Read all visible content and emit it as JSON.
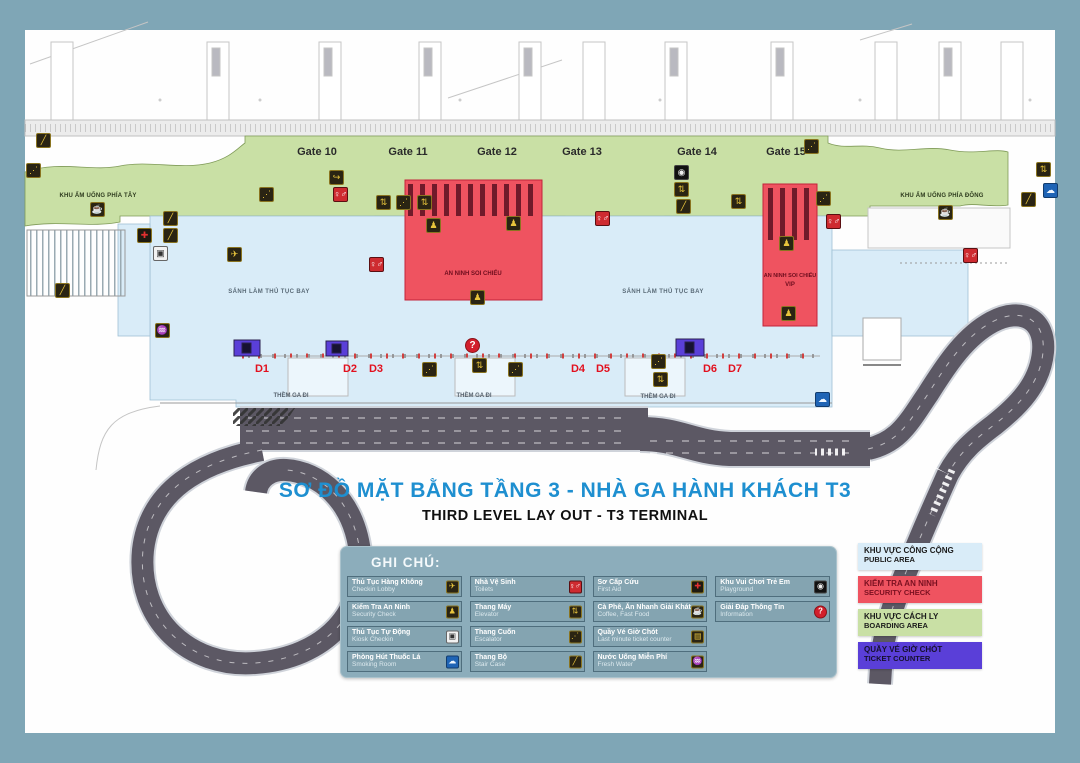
{
  "title": {
    "vi": "SƠ ĐỒ MẶT BẰNG TẦNG 3 - NHÀ GA HÀNH KHÁCH T3",
    "en": "THIRD LEVEL LAY OUT - T3 TERMINAL"
  },
  "gates": [
    "Gate 10",
    "Gate 11",
    "Gate  12",
    "Gate  13",
    "Gate 14",
    "Gate  15"
  ],
  "zones": {
    "west_food": "KHU ẨM UỐNG PHÍA TÂY",
    "east_food": "KHU ẨM UỐNG PHÍA ĐÔNG",
    "hall": "SẢNH LÀM THỦ TỤC BAY",
    "security_center": "AN NINH SOI CHIẾU",
    "security_vip_line1": "AN NINH SOI CHIẾU",
    "security_vip_line2": "VIP",
    "curb": "THỀM GA ĐI"
  },
  "d_labels": [
    "D1",
    "D2",
    "D3",
    "D4",
    "D5",
    "D6",
    "D7"
  ],
  "legend": {
    "title": "GHI CHÚ:",
    "items": [
      {
        "vi": "Thủ Tục Hàng Không",
        "en": "Checkin Lobby",
        "icon": "checkin",
        "row": 1,
        "col": 1
      },
      {
        "vi": "Nhà Vệ Sinh",
        "en": "Toilets",
        "icon": "toilets",
        "row": 1,
        "col": 2
      },
      {
        "vi": "Sơ Cấp Cứu",
        "en": "First Aid",
        "icon": "firstaid",
        "row": 1,
        "col": 3
      },
      {
        "vi": "Khu Vui Chơi Trẻ Em",
        "en": "Playground",
        "icon": "playground",
        "row": 1,
        "col": 4
      },
      {
        "vi": "Kiểm Tra An Ninh",
        "en": "Security Check",
        "icon": "security",
        "row": 2,
        "col": 1
      },
      {
        "vi": "Thang Máy",
        "en": "Elevator",
        "icon": "elevator",
        "row": 2,
        "col": 2
      },
      {
        "vi": "Cà Phê, Ăn Nhanh Giải Khát",
        "en": "Coffee, Fast Food",
        "icon": "coffee",
        "row": 2,
        "col": 3
      },
      {
        "vi": "Giải Đáp Thông Tin",
        "en": "Information",
        "icon": "info",
        "row": 2,
        "col": 4
      },
      {
        "vi": "Thủ Tục Tự Động",
        "en": "Kiosk Checkin",
        "icon": "kiosk",
        "row": 3,
        "col": 1
      },
      {
        "vi": "Thang Cuốn",
        "en": "Escalator",
        "icon": "escalator",
        "row": 3,
        "col": 2
      },
      {
        "vi": "Quầy Vé Giờ Chót",
        "en": "Last minute ticket counter",
        "icon": "ticket",
        "row": 3,
        "col": 3
      },
      {
        "vi": "Phòng Hút Thuốc Lá",
        "en": "Smoking Room",
        "icon": "smoking",
        "row": 4,
        "col": 1
      },
      {
        "vi": "Thang Bộ",
        "en": "Stair Case",
        "icon": "stairs",
        "row": 4,
        "col": 2
      },
      {
        "vi": "Nước Uống Miễn Phí",
        "en": "Fresh Water",
        "icon": "water",
        "row": 4,
        "col": 3
      }
    ]
  },
  "area_legend": [
    {
      "vi": "KHU VỰC CÔNG CỘNG",
      "en": "PUBLIC AREA",
      "color": "#D9ECF8",
      "text": "#1c1c1c"
    },
    {
      "vi": "KIỂM TRA AN NINH",
      "en": "SECURITY CHECK",
      "color": "#EF5360",
      "text": "#7A1020"
    },
    {
      "vi": "KHU VỰC CÁCH LY",
      "en": "BOARDING AREA",
      "color": "#C9E0A5",
      "text": "#1c1c1c"
    },
    {
      "vi": "QUẦY VÉ GIỜ CHÓT",
      "en": "TICKET COUNTER",
      "color": "#5A3FD8",
      "text": "#16102e"
    }
  ],
  "icon_defs": {
    "checkin": {
      "glyph": "✈",
      "bg": "#2A2413",
      "fg": "#E9C53C",
      "bd": "#8A7420"
    },
    "security": {
      "glyph": "♟",
      "bg": "#2A2413",
      "fg": "#E9C53C",
      "bd": "#8A7420"
    },
    "elevator": {
      "glyph": "⇅",
      "bg": "#2A2413",
      "fg": "#E9C53C",
      "bd": "#8A7420"
    },
    "escalator": {
      "glyph": "⋰",
      "bg": "#2A2413",
      "fg": "#E9C53C",
      "bd": "#8A7420"
    },
    "stairs": {
      "glyph": "╱",
      "bg": "#2A2413",
      "fg": "#E9C53C",
      "bd": "#8A7420"
    },
    "coffee": {
      "glyph": "☕",
      "bg": "#2A2413",
      "fg": "#E9C53C",
      "bd": "#8A7420"
    },
    "water": {
      "glyph": "♒",
      "bg": "#2A2413",
      "fg": "#E9C53C",
      "bd": "#8A7420"
    },
    "ticket": {
      "glyph": "▤",
      "bg": "#2A2413",
      "fg": "#E9C53C",
      "bd": "#8A7420"
    },
    "arrow": {
      "glyph": "↪",
      "bg": "#2A2413",
      "fg": "#E9C53C",
      "bd": "#8A7420"
    },
    "toilets": {
      "glyph": "♀♂",
      "bg": "#CE2B30",
      "fg": "#ffffff",
      "bd": "#5A0F12"
    },
    "kiosk": {
      "glyph": "▣",
      "bg": "#F2F2F2",
      "fg": "#333333",
      "bd": "#666666"
    },
    "smoking": {
      "glyph": "☁",
      "bg": "#1F64B5",
      "fg": "#EFF6FF",
      "bd": "#123C6E"
    },
    "firstaid": {
      "glyph": "✚",
      "bg": "#1E1A10",
      "fg": "#E13030",
      "bd": "#8A7420"
    },
    "playground": {
      "glyph": "◉",
      "bg": "#111111",
      "fg": "#EEEEEE",
      "bd": "#444444"
    },
    "info": {
      "glyph": "?",
      "bg": "#D21F2C",
      "fg": "#ffffff",
      "bd": "#8A1118",
      "round": true
    }
  },
  "map_icons": [
    {
      "t": "escalator",
      "x": 26,
      "y": 163
    },
    {
      "t": "stairs",
      "x": 36,
      "y": 133
    },
    {
      "t": "stairs",
      "x": 55,
      "y": 283
    },
    {
      "t": "coffee",
      "x": 90,
      "y": 202
    },
    {
      "t": "firstaid",
      "x": 137,
      "y": 228
    },
    {
      "t": "stairs",
      "x": 163,
      "y": 211
    },
    {
      "t": "stairs",
      "x": 163,
      "y": 228
    },
    {
      "t": "kiosk",
      "x": 153,
      "y": 246
    },
    {
      "t": "checkin",
      "x": 227,
      "y": 247
    },
    {
      "t": "water",
      "x": 155,
      "y": 323
    },
    {
      "t": "arrow",
      "x": 329,
      "y": 170
    },
    {
      "t": "escalator",
      "x": 259,
      "y": 187
    },
    {
      "t": "toilets",
      "x": 333,
      "y": 187
    },
    {
      "t": "elevator",
      "x": 376,
      "y": 195
    },
    {
      "t": "escalator",
      "x": 396,
      "y": 195
    },
    {
      "t": "elevator",
      "x": 417,
      "y": 195
    },
    {
      "t": "toilets",
      "x": 369,
      "y": 257
    },
    {
      "t": "security",
      "x": 426,
      "y": 218
    },
    {
      "t": "security",
      "x": 506,
      "y": 216
    },
    {
      "t": "security",
      "x": 470,
      "y": 290
    },
    {
      "t": "info",
      "x": 465,
      "y": 338
    },
    {
      "t": "escalator",
      "x": 422,
      "y": 362
    },
    {
      "t": "elevator",
      "x": 472,
      "y": 358
    },
    {
      "t": "escalator",
      "x": 508,
      "y": 362
    },
    {
      "t": "toilets",
      "x": 595,
      "y": 211
    },
    {
      "t": "escalator",
      "x": 651,
      "y": 354
    },
    {
      "t": "elevator",
      "x": 653,
      "y": 372
    },
    {
      "t": "playground",
      "x": 674,
      "y": 165
    },
    {
      "t": "elevator",
      "x": 674,
      "y": 182
    },
    {
      "t": "stairs",
      "x": 676,
      "y": 199
    },
    {
      "t": "elevator",
      "x": 731,
      "y": 194
    },
    {
      "t": "escalator",
      "x": 804,
      "y": 139
    },
    {
      "t": "escalator",
      "x": 816,
      "y": 191
    },
    {
      "t": "toilets",
      "x": 826,
      "y": 214
    },
    {
      "t": "security",
      "x": 779,
      "y": 236
    },
    {
      "t": "security",
      "x": 781,
      "y": 306
    },
    {
      "t": "smoking",
      "x": 815,
      "y": 392
    },
    {
      "t": "coffee",
      "x": 938,
      "y": 205
    },
    {
      "t": "elevator",
      "x": 1036,
      "y": 162
    },
    {
      "t": "smoking",
      "x": 1043,
      "y": 183
    },
    {
      "t": "stairs",
      "x": 1021,
      "y": 192
    },
    {
      "t": "toilets",
      "x": 963,
      "y": 248
    }
  ],
  "colors": {
    "border": "#7FA6B6",
    "public": "#D9ECF8",
    "boarding": "#C9E0A5",
    "security": "#EF5360",
    "ticket": "#5A3FD8",
    "road": "#5C5864",
    "title_blue": "#1E8FD0",
    "legend_bg": "#8CADBB"
  }
}
